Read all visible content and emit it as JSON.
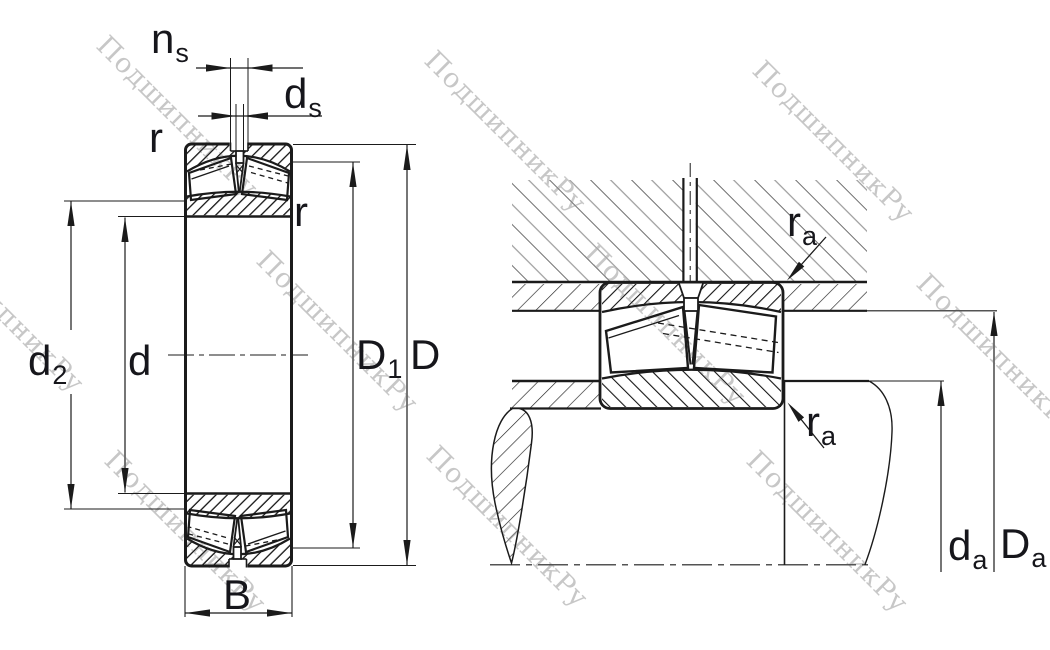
{
  "watermark": {
    "text": "ПодшипникРу",
    "color": "#c7c7c7"
  },
  "colors": {
    "line": "#1b1b1b",
    "label": "#16161b",
    "ring_hatch": "#141414",
    "housing_hatch_dark": "#2b2b2b",
    "housing_hatch_light": "#9a9a9a",
    "background": "#ffffff"
  },
  "left_figure": {
    "description": "spherical roller bearing cross section with dimensions",
    "labels": {
      "ns": {
        "base": "n",
        "sub": "s"
      },
      "ds": {
        "base": "d",
        "sub": "s"
      },
      "r_top": {
        "base": "r"
      },
      "r_inner": {
        "base": "r"
      },
      "d2": {
        "base": "d",
        "sub": "2"
      },
      "d": {
        "base": "d"
      },
      "D1": {
        "base": "D",
        "sub": "1"
      },
      "D": {
        "base": "D"
      },
      "B": {
        "base": "B"
      }
    }
  },
  "right_figure": {
    "description": "mounted bearing with shaft and housing abutment dimensions",
    "labels": {
      "ra_top": {
        "base": "r",
        "sub": "a"
      },
      "ra_bottom": {
        "base": "r",
        "sub": "a"
      },
      "da": {
        "base": "d",
        "sub": "a"
      },
      "Da": {
        "base": "D",
        "sub": "a"
      }
    }
  }
}
